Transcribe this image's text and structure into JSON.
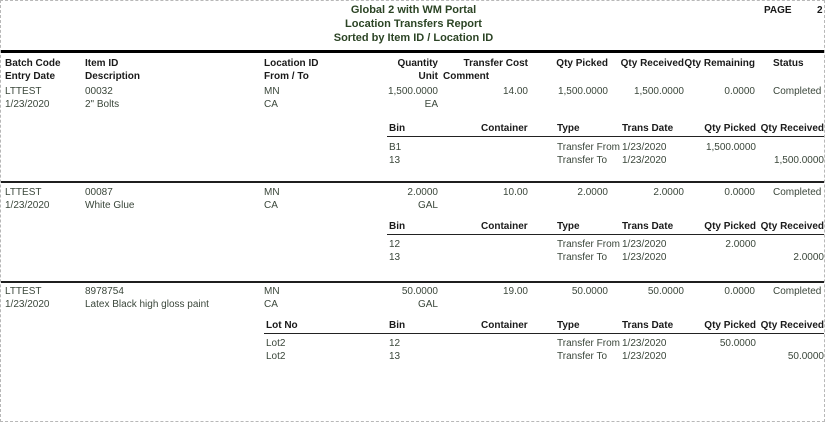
{
  "page": {
    "title": "Global 2 with WM Portal",
    "subtitle": "Location Transfers Report",
    "sort_line": "Sorted by Item ID / Location ID",
    "page_label": "PAGE",
    "page_number": "2"
  },
  "colors": {
    "title_text": "#2c4425",
    "data_text": "#3a463a",
    "header_text": "#1a1a1a",
    "rule": "#000000"
  },
  "columns": {
    "batch_code": "Batch Code",
    "entry_date": "Entry Date",
    "item_id": "Item ID",
    "description": "Description",
    "location_id": "Location ID",
    "from_to": "From / To",
    "quantity": "Quantity",
    "unit": "Unit",
    "transfer_cost": "Transfer Cost",
    "comment": "Comment",
    "qty_picked": "Qty Picked",
    "qty_received": "Qty Received",
    "qty_remaining": "Qty Remaining",
    "status": "Status"
  },
  "detail_columns": {
    "lot_no": "Lot No",
    "bin": "Bin",
    "container": "Container",
    "type": "Type",
    "trans_date": "Trans Date",
    "qty_picked": "Qty Picked",
    "qty_received": "Qty Received"
  },
  "blocks": [
    {
      "batch_code": "LTTEST",
      "entry_date": "1/23/2020",
      "item_id": "00032",
      "description": "2\" Bolts",
      "location_from": "MN",
      "location_to": "CA",
      "quantity": "1,500.0000",
      "unit": "EA",
      "transfer_cost": "14.00",
      "qty_picked": "1,500.0000",
      "qty_received": "1,500.0000",
      "qty_remaining": "0.0000",
      "status": "Completed",
      "details": [
        {
          "lot_no": "",
          "bin": "B1",
          "container": "",
          "type": "Transfer From",
          "trans_date": "1/23/2020",
          "qty_picked": "1,500.0000",
          "qty_received": ""
        },
        {
          "lot_no": "",
          "bin": "13",
          "container": "",
          "type": "Transfer To",
          "trans_date": "1/23/2020",
          "qty_picked": "",
          "qty_received": "1,500.0000"
        }
      ]
    },
    {
      "batch_code": "LTTEST",
      "entry_date": "1/23/2020",
      "item_id": "00087",
      "description": "White Glue",
      "location_from": "MN",
      "location_to": "CA",
      "quantity": "2.0000",
      "unit": "GAL",
      "transfer_cost": "10.00",
      "qty_picked": "2.0000",
      "qty_received": "2.0000",
      "qty_remaining": "0.0000",
      "status": "Completed",
      "details": [
        {
          "lot_no": "",
          "bin": "12",
          "container": "",
          "type": "Transfer From",
          "trans_date": "1/23/2020",
          "qty_picked": "2.0000",
          "qty_received": ""
        },
        {
          "lot_no": "",
          "bin": "13",
          "container": "",
          "type": "Transfer To",
          "trans_date": "1/23/2020",
          "qty_picked": "",
          "qty_received": "2.0000"
        }
      ]
    },
    {
      "batch_code": "LTTEST",
      "entry_date": "1/23/2020",
      "item_id": "8978754",
      "description": "Latex Black high gloss paint",
      "location_from": "MN",
      "location_to": "CA",
      "quantity": "50.0000",
      "unit": "GAL",
      "transfer_cost": "19.00",
      "qty_picked": "50.0000",
      "qty_received": "50.0000",
      "qty_remaining": "0.0000",
      "status": "Completed",
      "details": [
        {
          "lot_no": "Lot2",
          "bin": "12",
          "container": "",
          "type": "Transfer From",
          "trans_date": "1/23/2020",
          "qty_picked": "50.0000",
          "qty_received": ""
        },
        {
          "lot_no": "Lot2",
          "bin": "13",
          "container": "",
          "type": "Transfer To",
          "trans_date": "1/23/2020",
          "qty_picked": "",
          "qty_received": "50.0000"
        }
      ]
    }
  ]
}
